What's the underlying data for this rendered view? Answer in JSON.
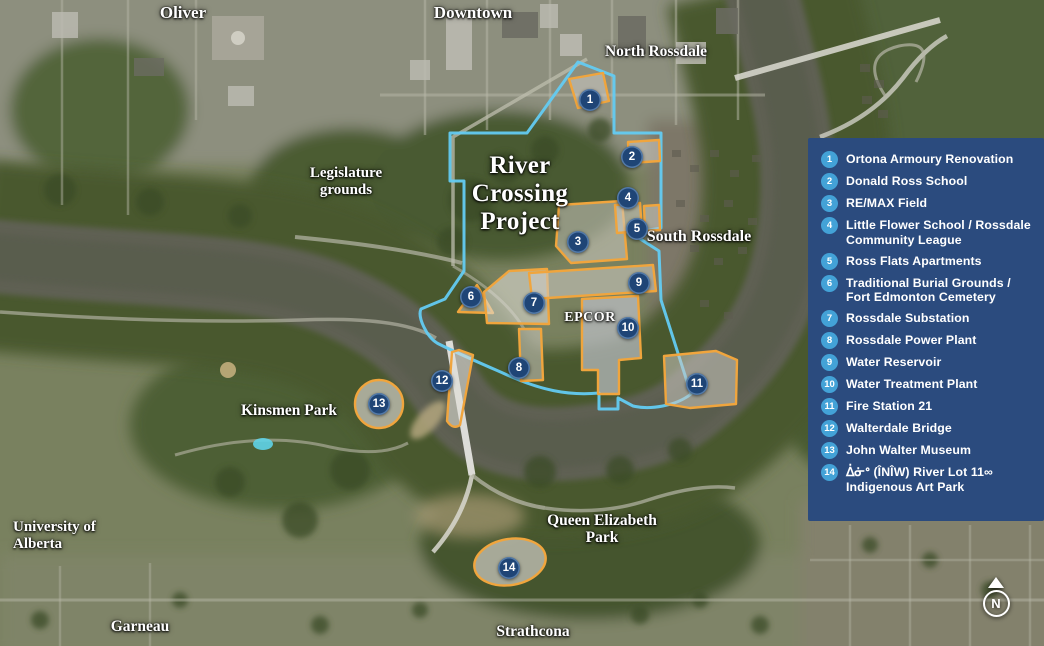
{
  "project_title": "River Crossing Project",
  "map_labels": {
    "oliver": "Oliver",
    "downtown": "Downtown",
    "north_rossdale": "North Rossdale",
    "legislature": "Legislature grounds",
    "south_rossdale": "South Rossdale",
    "epcor": "EPCOR",
    "kinsmen": "Kinsmen Park",
    "university": "University of Alberta",
    "queen_elizabeth": "Queen Elizabeth Park",
    "garneau": "Garneau",
    "strathcona": "Strathcona"
  },
  "map_markers": [
    "1",
    "2",
    "3",
    "4",
    "5",
    "6",
    "7",
    "8",
    "9",
    "10",
    "11",
    "12",
    "13",
    "14"
  ],
  "legend": {
    "items": [
      {
        "num": "1",
        "label": "Ortona Armoury Renovation"
      },
      {
        "num": "2",
        "label": "Donald Ross School"
      },
      {
        "num": "3",
        "label": "RE/MAX Field"
      },
      {
        "num": "4",
        "label": "Little Flower School / Rossdale Community League"
      },
      {
        "num": "5",
        "label": "Ross Flats Apartments"
      },
      {
        "num": "6",
        "label": "Traditional Burial Grounds / Fort Edmonton Cemetery"
      },
      {
        "num": "7",
        "label": "Rossdale Substation"
      },
      {
        "num": "8",
        "label": "Rossdale Power Plant"
      },
      {
        "num": "9",
        "label": "Water Reservoir"
      },
      {
        "num": "10",
        "label": "Water Treatment Plant"
      },
      {
        "num": "11",
        "label": "Fire Station 21"
      },
      {
        "num": "12",
        "label": "Walterdale Bridge"
      },
      {
        "num": "13",
        "label": "John Walter Museum"
      },
      {
        "num": "14",
        "label": "ᐄᓃᐤ (ÎNÎW) River Lot 11∞ Indigenous Art Park"
      }
    ]
  },
  "compass": {
    "label": "N"
  },
  "colors": {
    "legend_bg": "#2b4b7e",
    "legend_badge": "#43a2d7",
    "map_marker": "#1f4576",
    "project_boundary": "#63cbf2",
    "site_outline": "#f0a53d"
  }
}
